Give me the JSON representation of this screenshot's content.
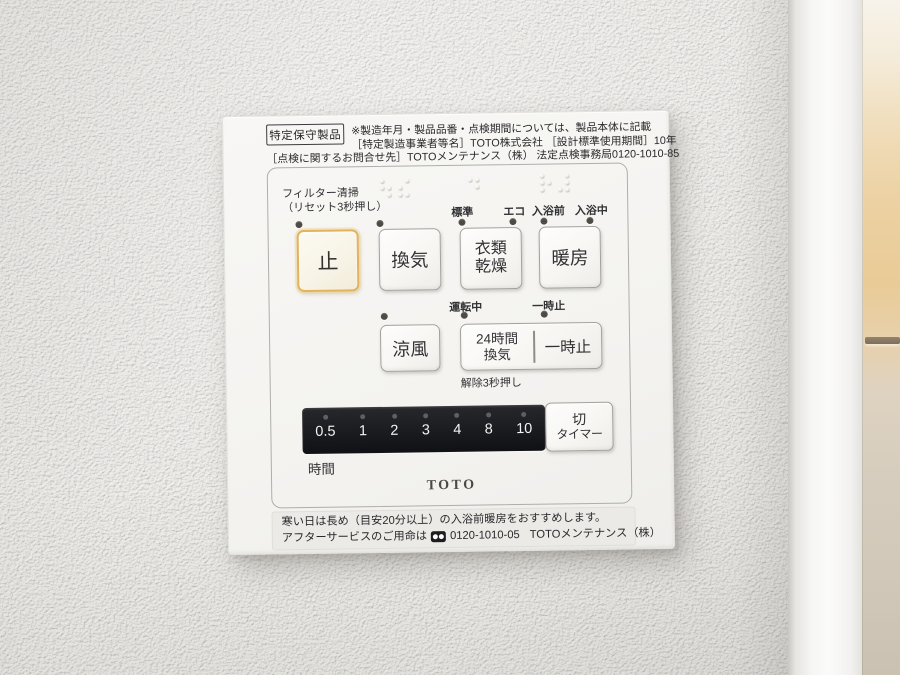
{
  "header": {
    "badge": "特定保守製品",
    "line1": "※製造年月・製品品番・点検期間については、製品本体に記載",
    "line2": "［特定製造事業者等名］TOTO株式会社 ［設計標準使用期間］10年",
    "line3": "［点検に関するお問合せ先］TOTOメンテナンス（株） 法定点検事務局0120-1010-85"
  },
  "controls": {
    "filter_label": "フィルター清掃",
    "filter_sublabel": "（リセット3秒押し）",
    "mode_labels": [
      "標準",
      "エコ",
      "入浴前",
      "入浴中"
    ],
    "stop": "止",
    "vent": "換気",
    "dry_line1": "衣類",
    "dry_line2": "乾燥",
    "heat": "暖房",
    "running_label": "運転中",
    "pause_label": "一時止",
    "cool": "涼風",
    "vent24_line1": "24時間",
    "vent24_line2": "換気",
    "pause_button": "一時止",
    "release_note": "解除3秒押し",
    "timer_values": [
      "0.5",
      "1",
      "2",
      "3",
      "4",
      "8",
      "10"
    ],
    "timer_unit": "時間",
    "timer_off_line1": "切",
    "timer_off_line2": "タイマー",
    "brand": "TOTO"
  },
  "footer": {
    "line1": "寒い日は長め（目安20分以上）の入浴前暖房をおすすめします。",
    "line2_prefix": "アフターサービスのご用命は",
    "line2_phone": "0120-1010-05",
    "line2_company": "TOTOメンテナンス（株）"
  },
  "colors": {
    "stop_button_border": "#e2b25c",
    "led_off": "#4e4a44",
    "timer_display_bg": "#17181c"
  }
}
